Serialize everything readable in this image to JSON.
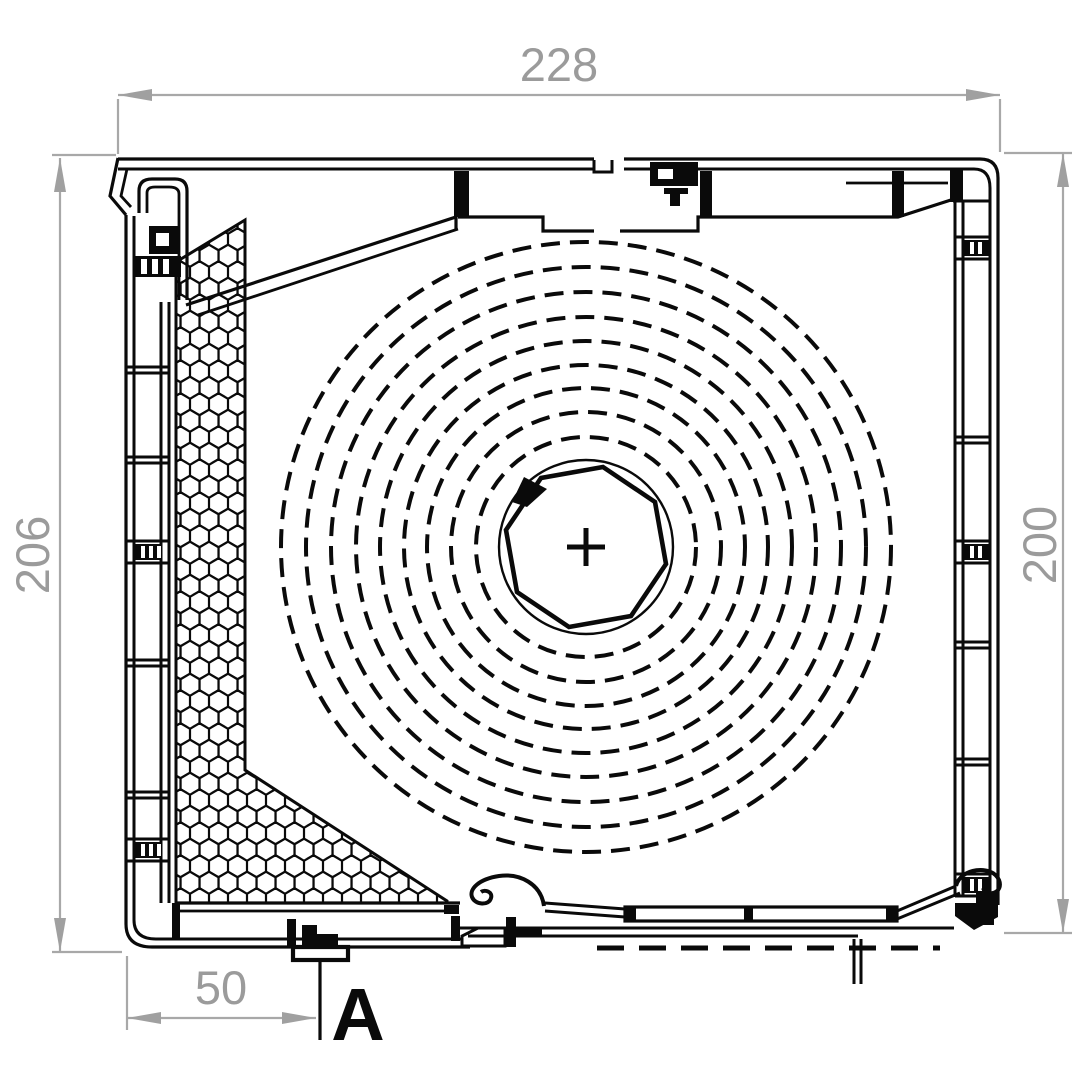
{
  "page": {
    "background": "#ffffff"
  },
  "drawing": {
    "type": "technical-cross-section-roller-shutter-box",
    "dimensions": {
      "width_top": {
        "value": "228"
      },
      "height_left": {
        "value": "206"
      },
      "height_right": {
        "value": "200"
      },
      "offset_bottom_left": {
        "value": "50"
      }
    },
    "section_marker": {
      "label": "A"
    },
    "shaft": {
      "center_mark": "+",
      "shape": "octagon"
    },
    "shutter_roll": {
      "center": [
        586,
        547
      ],
      "radii": [
        110,
        135,
        159,
        182,
        206,
        230,
        255,
        280,
        305
      ]
    },
    "colors": {
      "profile": "#0a0a0a",
      "dimension_line": "#a8a8a8",
      "dimension_text": "#9b9b9b",
      "arrow": "#a0a0a0"
    }
  }
}
